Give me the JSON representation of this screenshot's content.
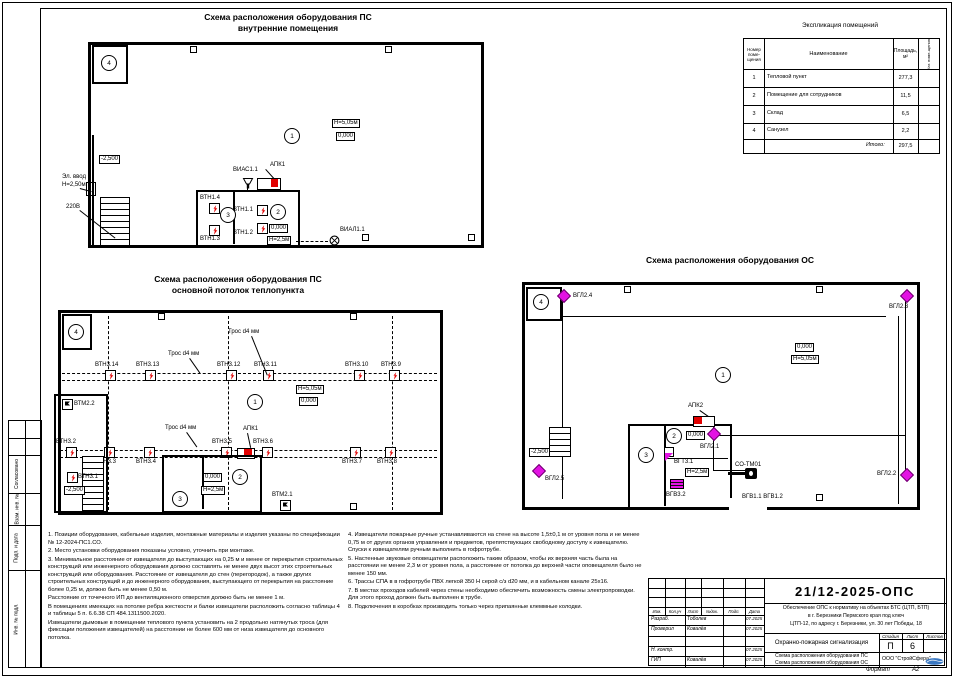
{
  "explication": {
    "title": "Экспликация помещений",
    "col_num": "Номер\nпоме-\nщения",
    "col_name": "Наименование",
    "col_area": "Площадь,\nм²",
    "col_cat": "Кат. поме-щения",
    "rows": [
      {
        "num": "1",
        "name": "Тепловой пункт",
        "area": "277,3"
      },
      {
        "num": "2",
        "name": "Помещение для сотрудников",
        "area": "11,5"
      },
      {
        "num": "3",
        "name": "Склад",
        "area": "6,5"
      },
      {
        "num": "4",
        "name": "Санузел",
        "area": "2,2"
      }
    ],
    "total_label": "Итого:",
    "total_area": "297,5"
  },
  "plan1": {
    "title1": "Схема расположения оборудования ПС",
    "title2": "внутренние помещения",
    "rooms": {
      "r1": "1",
      "r2": "2",
      "r3": "3",
      "r4": "4"
    },
    "h_main": "Н=5,05м",
    "lvl_main": "0,000",
    "lvl_low": "-2,500",
    "el1": "Эл. ввод",
    "el2": "Н=2,50м",
    "power": "220В",
    "sounder": "ВИАС1.1",
    "panel": "АПК1",
    "lamp": "ВИАЛ1.1",
    "lvl_room": "0,000",
    "h_room": "Н=2,5м",
    "d14": "ВТН1.4",
    "d13": "ВТН1.3",
    "d11": "ВТН1.1",
    "d12": "ВТН1.2"
  },
  "plan2": {
    "title1": "Схема расположения оборудования ПС",
    "title2": "основной потолок теплопункта",
    "rooms": {
      "r1": "1",
      "r2": "2",
      "r3": "3",
      "r4": "4"
    },
    "h_main": "Н=5,05м",
    "lvl_main": "0,000",
    "lvl_low": "-2,500",
    "lvl_room": "0,000",
    "h_room": "Н=2,5м",
    "panel": "АПК1",
    "cable": "Трос d4 мм",
    "m22": "ВТМ2.2",
    "m21": "ВТМ2.1",
    "d31": "ВТН3.1",
    "top": [
      "ВТН3.14",
      "ВТН3.13",
      "ВТН3.12",
      "ВТН3.11",
      "ВТН3.10",
      "ВТН3.9"
    ],
    "bottom": [
      "ВТН3.2",
      "ВТН3.3",
      "ВТН3.4",
      "ВТН3.5",
      "ВТН3.6",
      "ВТН3.7",
      "ВТН3.8"
    ]
  },
  "plan3": {
    "title": "Схема расположения оборудования ОС",
    "rooms": {
      "r1": "1",
      "r2": "2",
      "r3": "3",
      "r4": "4"
    },
    "h_main": "Н=5,05м",
    "lvl_main": "0,000",
    "lvl_low": "-2,500",
    "lvl_room": "0,000",
    "h_room": "Н=2,5м",
    "panel": "АПК2",
    "g24": "ВГЛ2.4",
    "g23": "ВГЛ2.3",
    "g22": "ВГЛ2.2",
    "g21": "ВГЛ2.1",
    "g25": "ВГЛ2.5",
    "gt31": "ВГТ3.1",
    "reader": "СО-ТМ01",
    "gb32": "ВГВ3.2",
    "gb1112": "ВГВ1.1 ВГВ1.2"
  },
  "notes": {
    "left": [
      "1. Позиции оборудования, кабельные изделия, монтажные материалы и изделия указаны по спецификации № 12-2024-ПС1.СО.",
      "2. Место установки оборудования показаны условно, уточнить при монтаже.",
      "3. Минимальное расстояние от извещателя до выступающих на 0,25 м и менее от перекрытия строительных конструкций или инженерного оборудования должно составлять не менее двух высот этих строительных конструкций или оборудования. Расстояние от извещателя до стен (перегородок), а также других строительных конструкций и до инженерного оборудования, выступающего от перекрытия на расстояние более 0,25 м, должно быть не менее 0,50 м.",
      "Расстояние от точечного ИП до вентиляционного отверстия должно быть не менее 1 м.",
      "В помещениях имеющих на потолке ребра жесткости и балки извещатели расположить согласно таблицы 4 и таблицы 5 п. 6.6.38 СП 484.1311500.2020.",
      "Извещатели дымовые в помещении теплового пункта установить на 2 продольно натянутых троса (для фиксации положения извещателей) на расстоянии не более 600 мм от низа извещателя до основного потолка."
    ],
    "right": [
      "4. Извещатели пожарные ручные устанавливаются на стене на высоте 1,5±0,1 м от уровня пола и не менее 0,75 м от других органов управления и предметов, препятствующих свободному доступу к извещателю. Спуски к извещателям ручным выполнить в гофротрубе.",
      "5. Настенные звуковые оповещатели расположить таким образом, чтобы их верхняя часть была на расстоянии не менее 2,3 м от уровня пола, а расстояние от потолка до верхней части оповещателя было не менее 150 мм.",
      "6. Трассы СПА в  в гофротрубе ПВХ легкой 350 Н серой с/з d20 мм, и в кабельном канале 25х16.",
      "7. В местах проходов кабелей через стены необходимо обеспечить возможность смены электропроводки. Для этого проход должен быть выполнен в трубе.",
      "8. Подключения в коробках производить только через припаянные клеммные колодки."
    ]
  },
  "stamp": {
    "doc_number": "21/12-2025-ОПС",
    "desc1": "Обеспечение ОПС к нормативу на объектах БТС (ЦТП, БТП)",
    "desc2": "в г. Березники Пермского края под ключ",
    "desc3": "ЦТП-12, по адресу г. Березники, ул. 30 лет Победы, 18",
    "system_name": "Охранно-пожарная сигнализация",
    "drawing1": "Схема расположения оборудования ПС",
    "drawing2": "Схема расположения оборудования ОС",
    "stage_label": "Стадия",
    "sheet_label": "Лист",
    "sheets_label": "Листов",
    "stage": "П",
    "sheet_no": "6",
    "company": "ООО \"СтройСфера\"",
    "format_label": "Формат",
    "format_value": "А2",
    "cols": [
      "Изм.",
      "Кол.уч",
      "Лист",
      "№док.",
      "Подп.",
      "Дата"
    ],
    "rows": [
      {
        "role": "Разраб.",
        "name": "Тоболев",
        "date": "07.2025"
      },
      {
        "role": "Проверил",
        "name": "Ковалёв",
        "date": "07.2025"
      },
      {
        "role": "",
        "name": "",
        "date": ""
      },
      {
        "role": "Н. контр.",
        "name": "",
        "date": "07.2025"
      },
      {
        "role": "ГИП",
        "name": "Ковалёв",
        "date": "07.2025"
      }
    ]
  },
  "side": {
    "s1": "Согласовано",
    "s2": "Взам. инв. №",
    "s3": "Подп. и дата",
    "s4": "Инв. № подл."
  }
}
